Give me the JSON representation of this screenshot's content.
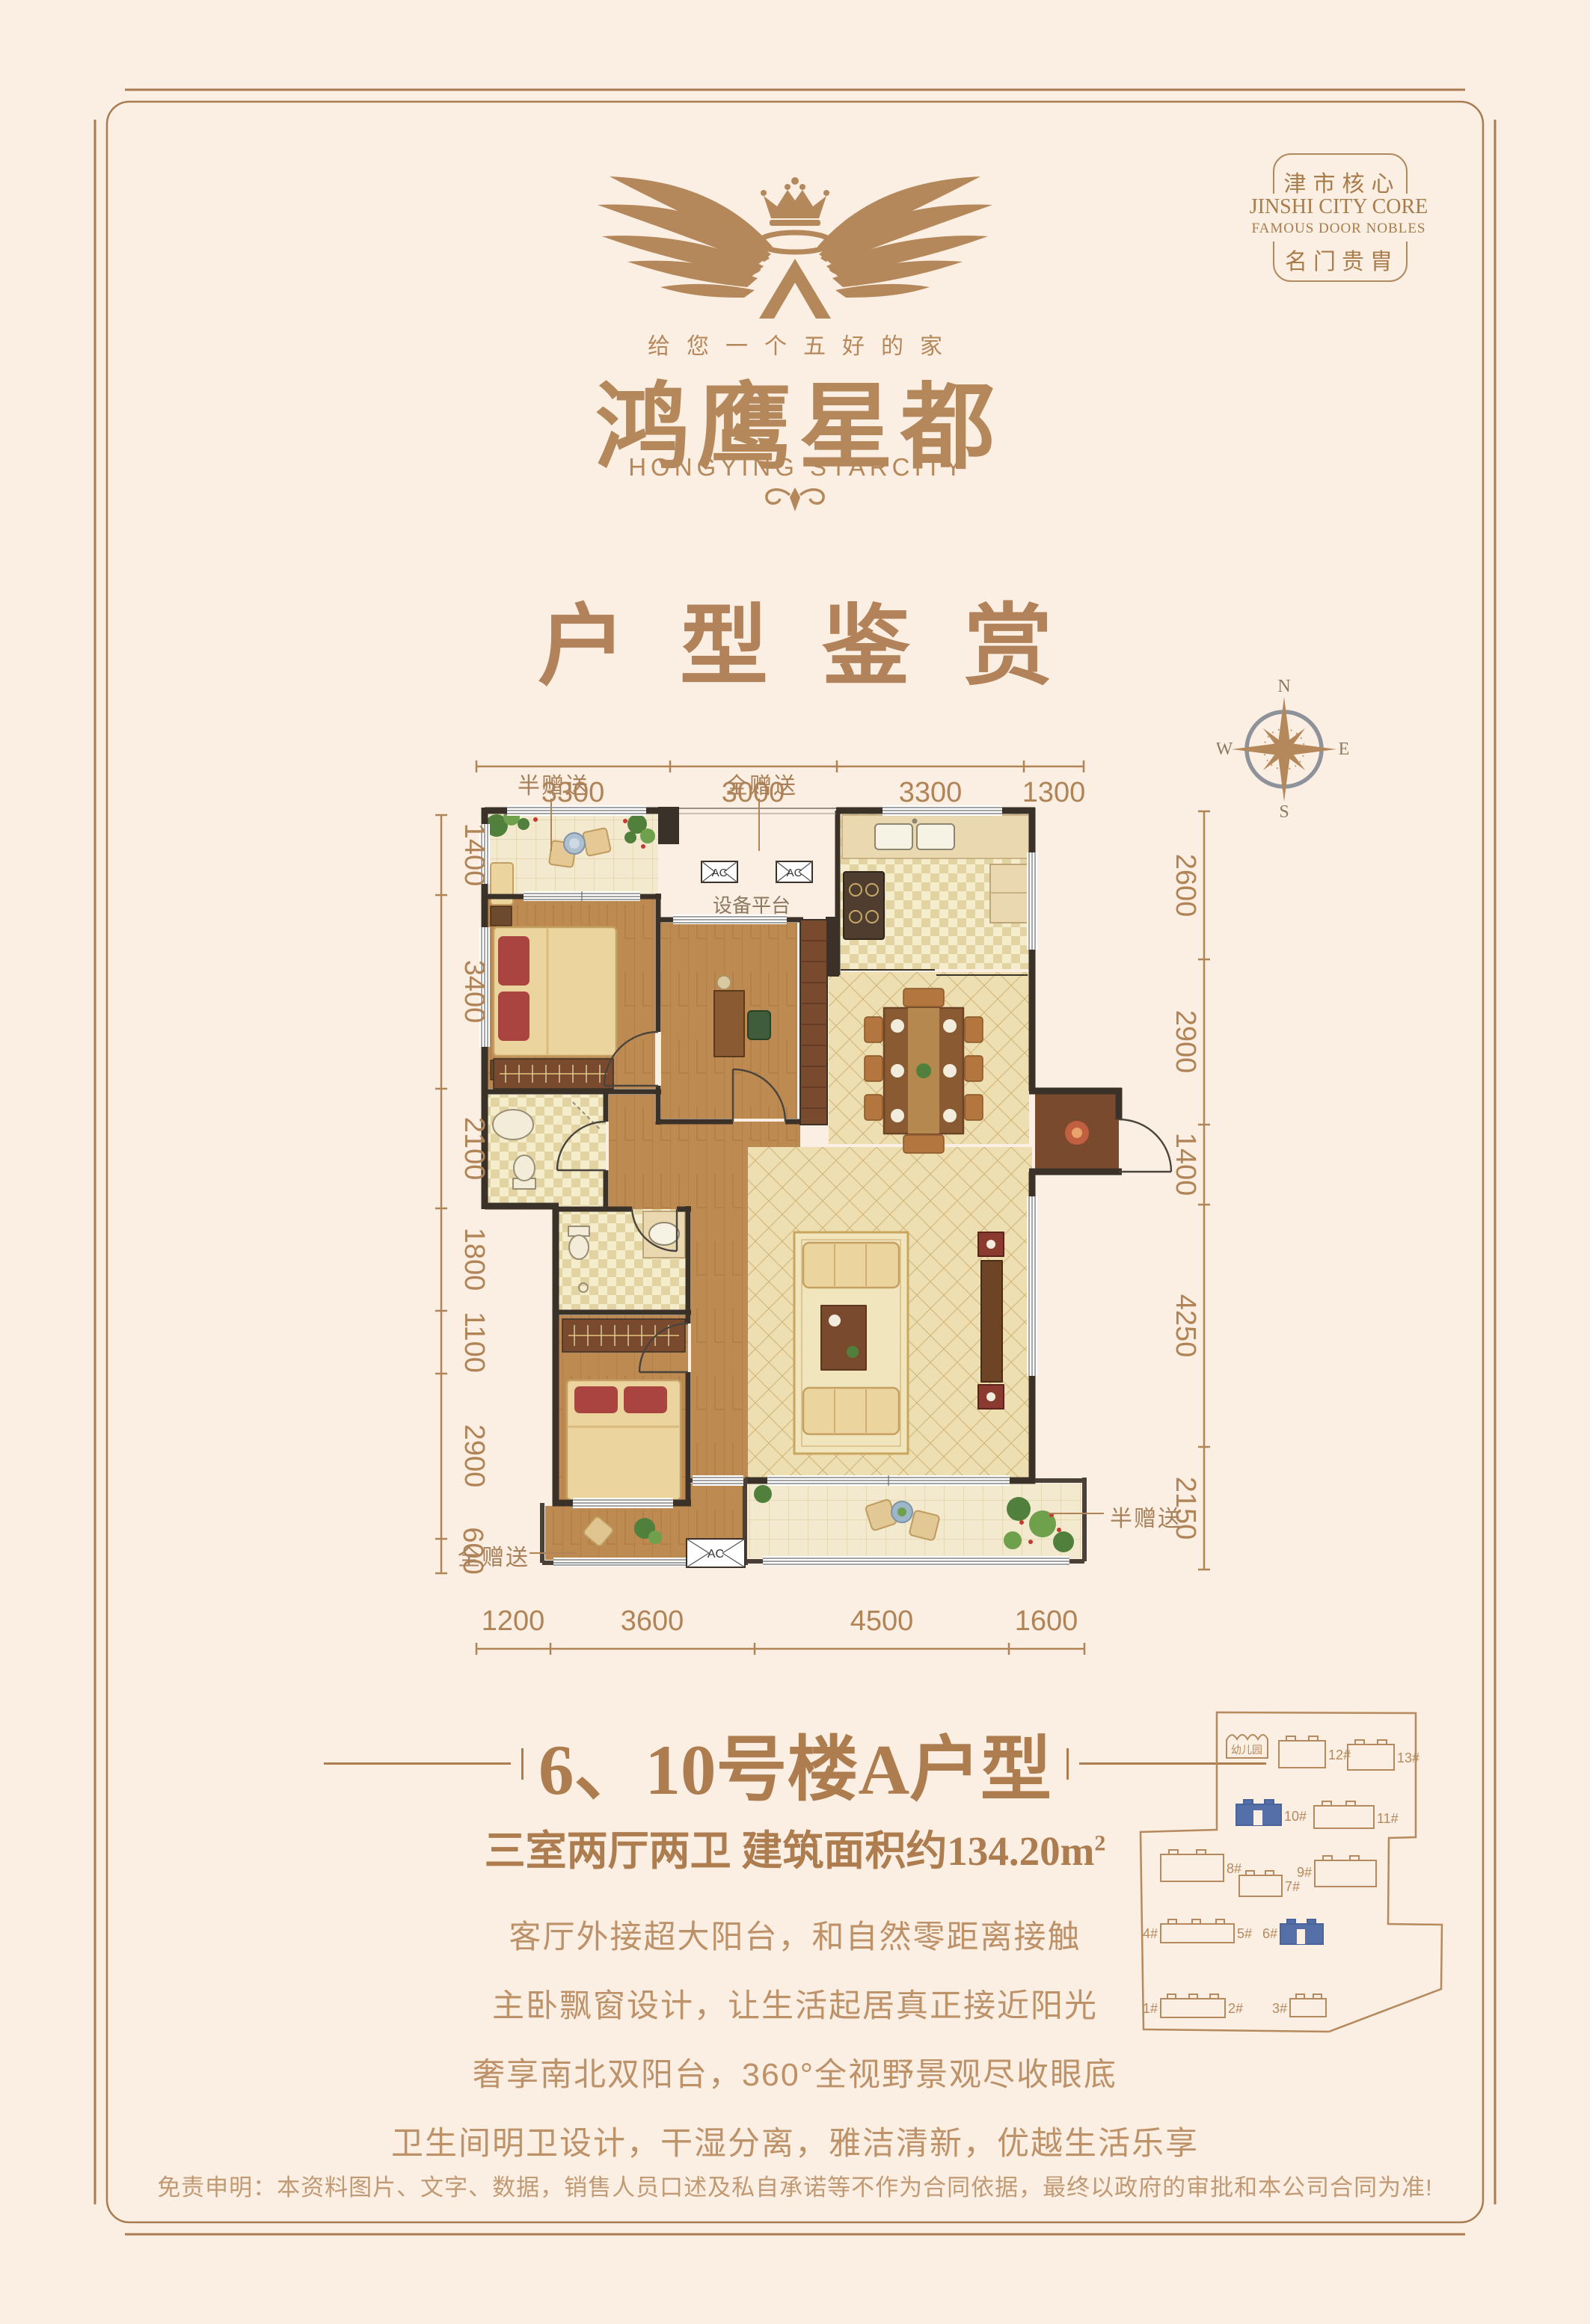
{
  "badge": {
    "cn_top": "津市核心",
    "en_line1": "JINSHI CITY CORE",
    "en_line2": "FAMOUS DOOR NOBLES",
    "cn_bottom": "名门贵胄"
  },
  "logo": {
    "tagline": "给您一个五好的家",
    "brand_cn": "鸿鹰星都",
    "brand_en": "HONGYING STARCITY"
  },
  "page_title": "户型鉴赏",
  "compass": {
    "north": "N",
    "east": "E",
    "south": "S",
    "west": "W"
  },
  "floor_plan": {
    "dims_top": [
      "3300",
      "3000",
      "3300",
      "1300"
    ],
    "dims_left": [
      "1400",
      "3400",
      "2100",
      "1800",
      "1100",
      "2900",
      "600"
    ],
    "dims_right": [
      "2600",
      "2900",
      "1400",
      "4250",
      "2150"
    ],
    "dims_bottom": [
      "1200",
      "3600",
      "4500",
      "1600"
    ],
    "labels": {
      "half_gift": "半赠送",
      "full_gift": "全赠送",
      "equipment_platform": "设备平台",
      "ac": "AC"
    }
  },
  "unit": {
    "title": "6、10号楼A户型",
    "subtitle": "三室两厅两卫 建筑面积约134.20m",
    "area_sup": "2",
    "features": [
      "客厅外接超大阳台，和自然零距离接触",
      "主卧飘窗设计，让生活起居真正接近阳光",
      "奢享南北双阳台，360°全视野景观尽收眼底",
      "卫生间明卫设计，干湿分离，雅洁清新，优越生活乐享"
    ]
  },
  "site_plan": {
    "kindergarten": "幼儿园",
    "buildings": [
      "12#",
      "13#",
      "10#",
      "11#",
      "8#",
      "9#",
      "7#",
      "4#",
      "5#",
      "6#",
      "1#",
      "2#",
      "3#"
    ],
    "highlighted": [
      "10#",
      "6#"
    ]
  },
  "disclaimer": "免责申明：本资料图片、文字、数据，销售人员口述及私自承诺等不作为合同依据，最终以政府的审批和本公司合同为准!",
  "colors": {
    "background": "#fbeee2",
    "brand_brown": "#b5885c",
    "wall_dark": "#3a3129",
    "highlight_blue": "#5570a8"
  }
}
